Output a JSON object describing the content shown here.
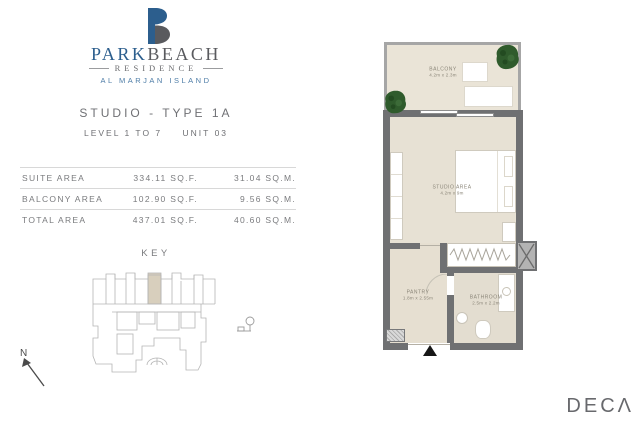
{
  "brand": {
    "park": "PARK",
    "beach": "BEACH",
    "residence": "RESIDENCE",
    "location": "AL MARJAN ISLAND"
  },
  "unit": {
    "title": "STUDIO - TYPE 1A",
    "level": "LEVEL 1 TO 7",
    "number": "UNIT 03"
  },
  "areas": {
    "rows": [
      {
        "label": "SUITE AREA",
        "sqf": "334.11 SQ.F.",
        "sqm": "31.04 SQ.M."
      },
      {
        "label": "BALCONY AREA",
        "sqf": "102.90 SQ.F.",
        "sqm": "9.56 SQ.M."
      },
      {
        "label": "TOTAL AREA",
        "sqf": "437.01 SQ.F.",
        "sqm": "40.60 SQ.M."
      }
    ]
  },
  "key": {
    "label": "KEY"
  },
  "floorplan": {
    "balcony": {
      "name": "BALCONY",
      "dims": "4.2m x 2.3m"
    },
    "studio": {
      "name": "STUDIO AREA",
      "dims": "4.2m x 9m"
    },
    "pantry": {
      "name": "PANTRY",
      "dims": "1.8m x 2.55m"
    },
    "bathroom": {
      "name": "BATHROOM",
      "dims": "2.5m x 2.2m"
    }
  },
  "compass": {
    "label": "N"
  },
  "footer": {
    "logo": "DECΛ"
  },
  "colors": {
    "brand_blue": "#2c5e8d",
    "brand_gray": "#595a5e",
    "text_gray": "#77787c",
    "floor_beige": "#e7e1d4",
    "wall_gray": "#6f7072",
    "key_highlight": "#d8cfbd",
    "plant_green": "#2f5b2c"
  }
}
